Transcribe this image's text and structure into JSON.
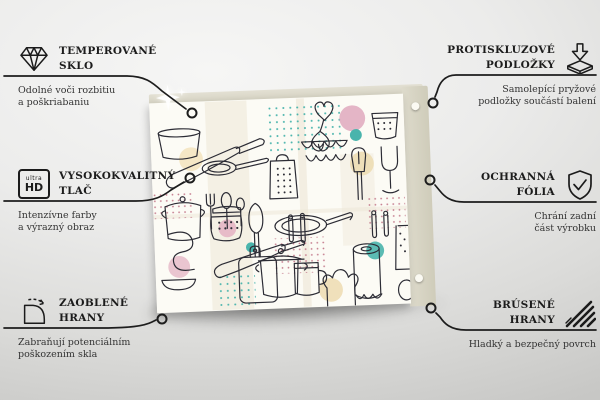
{
  "product": {
    "name": "kitchen-doodle-glass-panel",
    "description": "Glass panel printed with kitchen utensils doodle pattern",
    "accent_colors": {
      "teal": "#49b4ac",
      "pink": "#e0a9bd",
      "beige": "#ecd9ad",
      "panel_edge": "#d5d2c2",
      "line": "#2c2c35"
    }
  },
  "ultra_hd_icon": {
    "top": "ultra",
    "bottom": "HD"
  },
  "features": {
    "left": [
      {
        "icon": "diamond-icon",
        "title_line1": "TEMPEROVANÉ",
        "title_line2": "SKLO",
        "desc_line1": "Odolné voči rozbitiu",
        "desc_line2": "a poškriabaniu"
      },
      {
        "icon": "ultra-hd-icon",
        "title_line1": "VYSOKOKVALITNÝ",
        "title_line2": "TLAČ",
        "desc_line1": "Intenzívne farby",
        "desc_line2": "a výrazný obraz"
      },
      {
        "icon": "rounded-corner-icon",
        "title_line1": "ZAOBLENÉ",
        "title_line2": "HRANY",
        "desc_line1": "Zabraňují potenciálním",
        "desc_line2": "poškozením skla"
      }
    ],
    "right": [
      {
        "icon": "anti-slip-pad-icon",
        "title_line1": "PROTISKLUZOVÉ",
        "title_line2": "PODLOŽKY",
        "desc_line1": "Samolepící pryžové",
        "desc_line2": "podložky součástí balení"
      },
      {
        "icon": "shield-check-icon",
        "title_line1": "OCHRANNÁ",
        "title_line2": "FÓLIA",
        "desc_line1": "Chrání zadní",
        "desc_line2": "část výrobku"
      },
      {
        "icon": "ground-edge-icon",
        "title_line1": "BRÚSENÉ",
        "title_line2": "HRANY",
        "desc_line1": "Hladký a bezpečný povrch",
        "desc_line2": ""
      }
    ]
  }
}
